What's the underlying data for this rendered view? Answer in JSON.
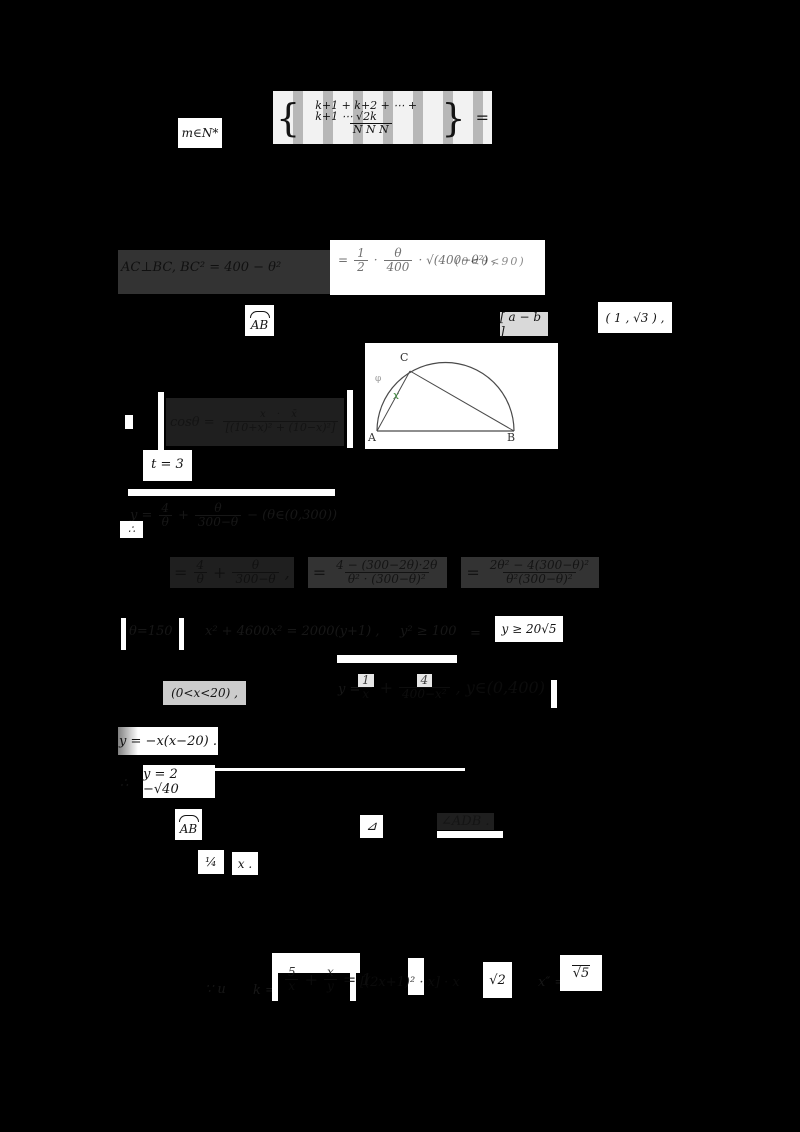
{
  "top": {
    "label": "m∈N*",
    "open": "{",
    "num": "k+1 + k+2 + ⋯ + k+1 ⋯ √2k",
    "den": "N         N         N",
    "close": "}",
    "eq": "="
  },
  "sec2": {
    "left": "AC⊥BC, BC² = 400 − θ²",
    "eq": "=",
    "f1num": "1",
    "f1den": "2",
    "dot": "·",
    "f2num": "θ",
    "f2den": "400",
    "tail": "· √(400−θ²) ,",
    "range": "(0<θ<90)"
  },
  "row3": {
    "ab": "AB",
    "mid": "[ a − b ]",
    "right": "( 1 , √3 ) ,"
  },
  "diagram": {
    "a": "A",
    "b": "B",
    "c": "C",
    "x": "x",
    "phi": "φ"
  },
  "cos": {
    "intro": "cosθ =",
    "num": "x · x̄",
    "den": "[(10+x)² + (10−x)²]"
  },
  "t3": {
    "text": "t = 3"
  },
  "yprime1": {
    "lead": "y =",
    "f1num": "4",
    "f1den": "θ",
    "plus": "+",
    "f2num": "θ",
    "f2den": "300−θ",
    "tail": "− (θ∈(0,300))",
    "therefore": "∴"
  },
  "big": {
    "eq1": "=",
    "f1num": "4",
    "f1den": "θ",
    "plus": "+",
    "f2num": "θ",
    "f2den": "300−θ",
    "comma": ",",
    "eq2": "=",
    "f3num": "4 − (300−2θ)·2θ",
    "f3den": "θ² · (300−θ)²",
    "eq3": "=",
    "f4num": "2θ² − 4(300−θ)²",
    "f4den": "θ²(300−θ)²"
  },
  "row620": {
    "b1": "θ=150",
    "mid": "x² + 4600x² = 2000(y+1) ,",
    "ge": "y² ≥ 100",
    "eq": "=",
    "right": "y ≥ 20√5"
  },
  "row672": {
    "range": "(0<x<20) ,",
    "eq": "y =",
    "f1num": "1",
    "f1den": "x",
    "plus": "+",
    "f2num": "4",
    "f2den": "400−x²",
    "tail": ", y∈(0,400) ."
  },
  "row727": {
    "text": "y = −x(x−20) ."
  },
  "row765": {
    "pre": "∴",
    "text": "y = 2 −√40"
  },
  "row809": {
    "ab": "AB",
    "tri": "⊿",
    "angle": "∠ADB ."
  },
  "row850": {
    "p1": "¼",
    "p2": "x ."
  },
  "bottom": {
    "intro": "∵ u",
    "k": "k =",
    "f1num": "5",
    "f1den": "x",
    "plus": "+",
    "f2num": "x",
    "f2den": "y",
    "eq1": "= 1",
    "bracket": "[(2x+1)² · x] · x",
    "v2": "√2",
    "xeq": "x″ =",
    "v5": "√5"
  }
}
